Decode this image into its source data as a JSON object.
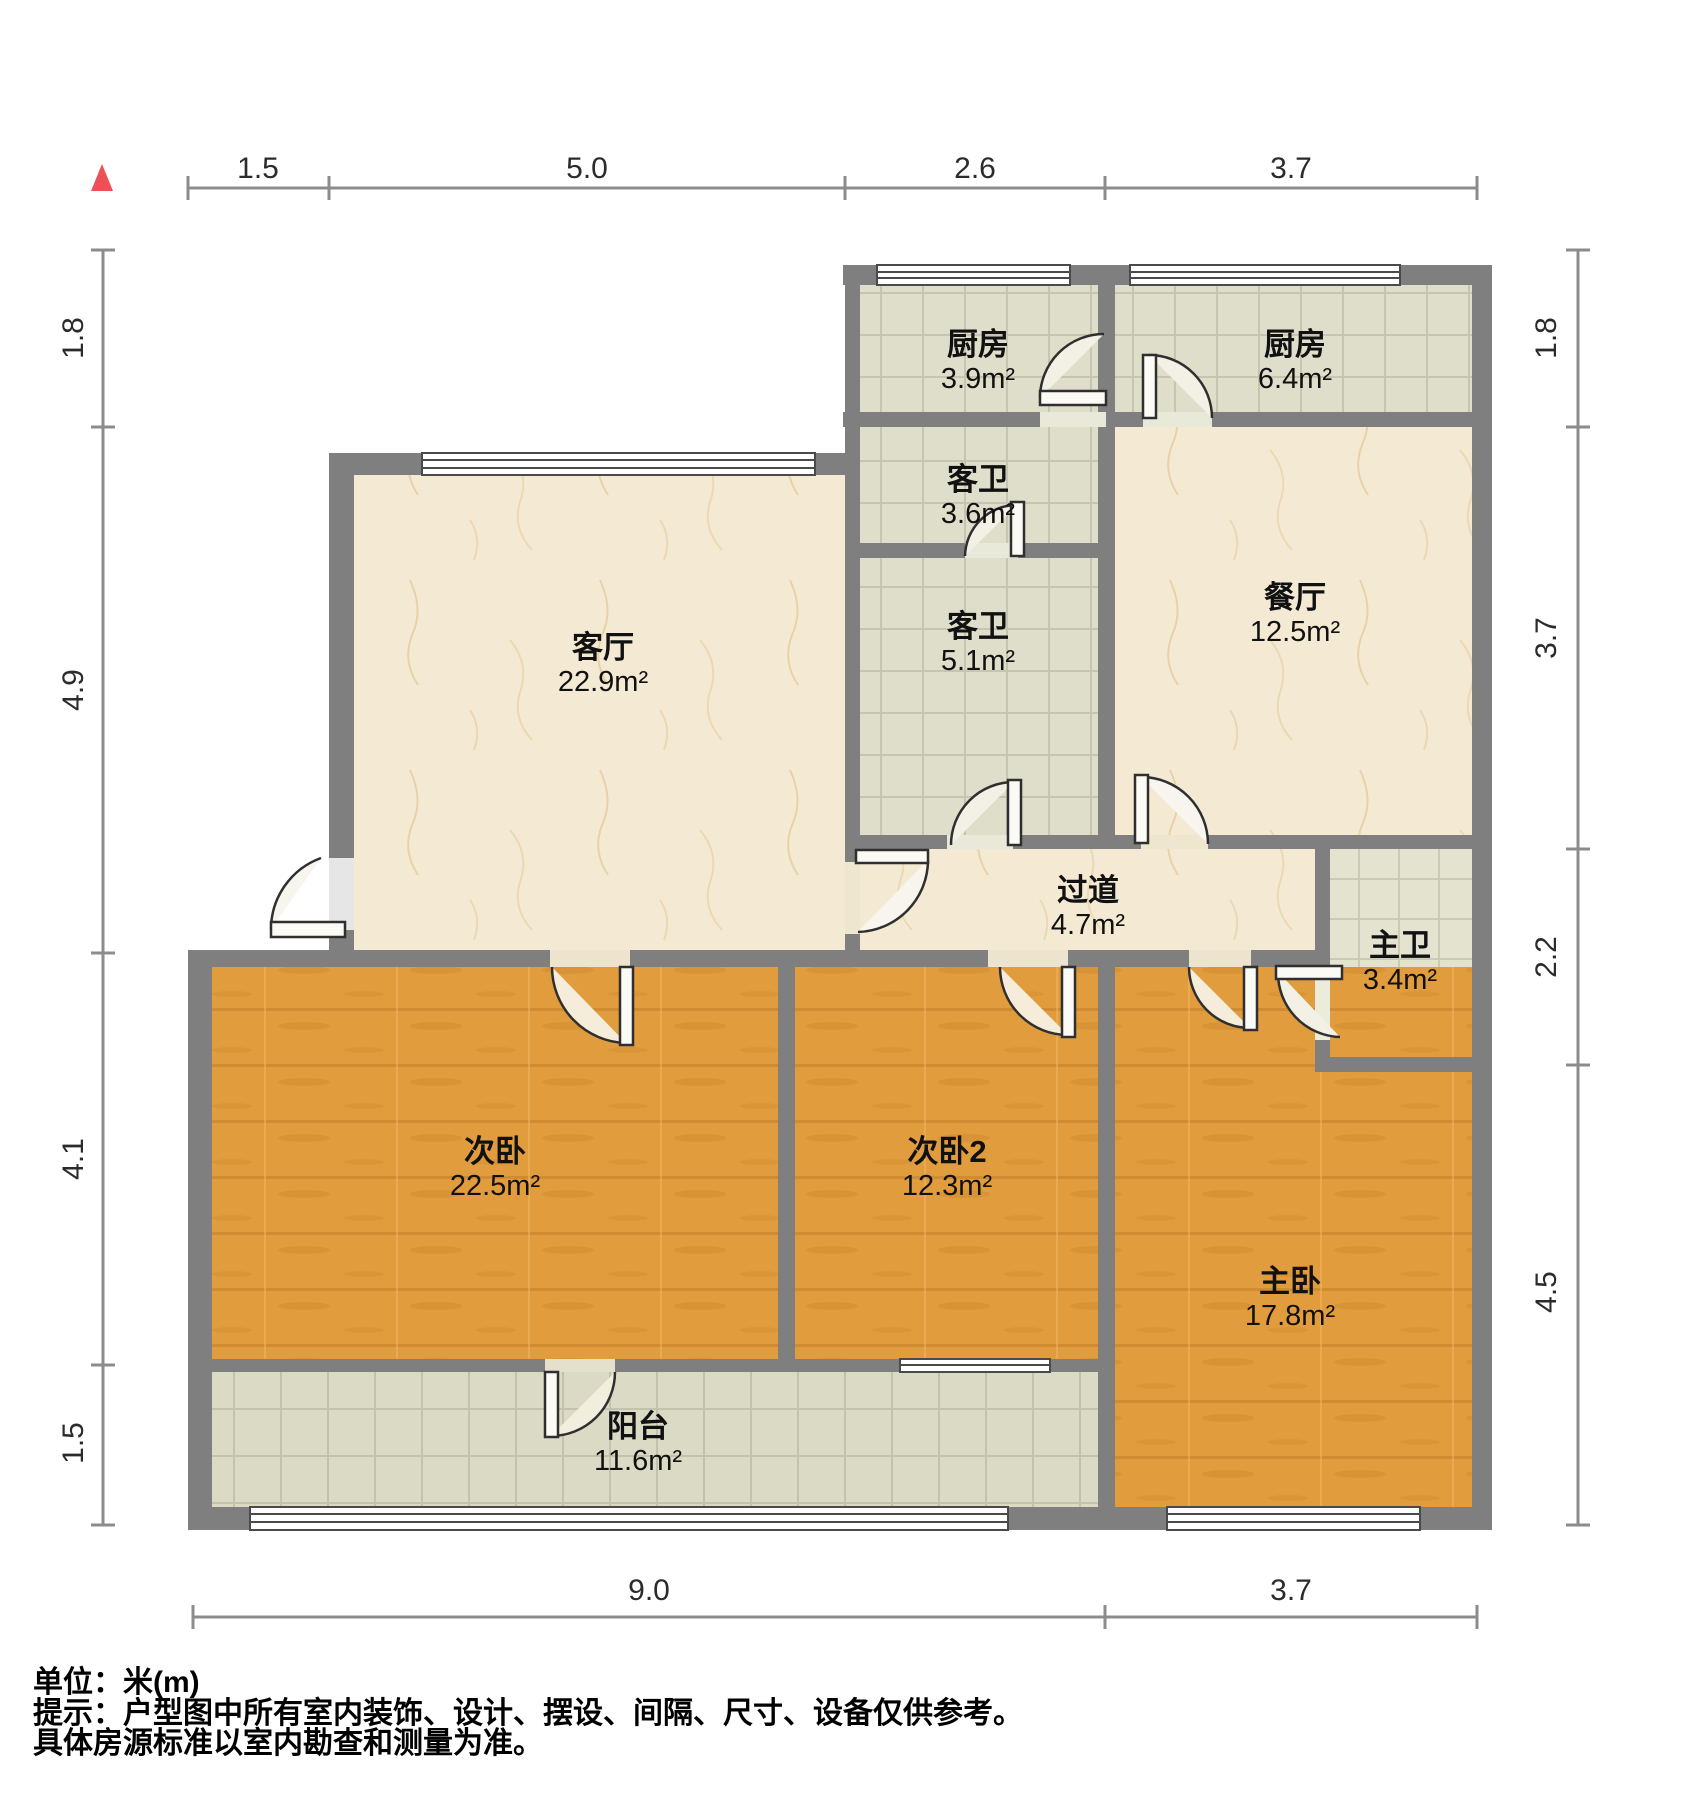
{
  "title": "户型图",
  "north_indicator": "north-arrow",
  "colors": {
    "wall": "#7f7f7f",
    "north_arrow_red": "#ee5055",
    "marble_floor": "#f4ead4",
    "tile_floor": "#dedeca",
    "balcony_tile_floor": "#dbdbc5",
    "master_bath_tile": "#e3e3d0",
    "wood_floor": "#e19c3e",
    "dim_line": "#8c8c8c",
    "dim_text": "#2b2b2b"
  },
  "rooms": [
    {
      "name": "厨房",
      "area": "3.9m²"
    },
    {
      "name": "厨房",
      "area": "6.4m²"
    },
    {
      "name": "客卫",
      "area": "3.6m²"
    },
    {
      "name": "客卫",
      "area": "5.1m²"
    },
    {
      "name": "餐厅",
      "area": "12.5m²"
    },
    {
      "name": "客厅",
      "area": "22.9m²"
    },
    {
      "name": "过道",
      "area": "4.7m²"
    },
    {
      "name": "主卫",
      "area": "3.4m²"
    },
    {
      "name": "次卧",
      "area": "22.5m²"
    },
    {
      "name": "次卧2",
      "area": "12.3m²"
    },
    {
      "name": "主卧",
      "area": "17.8m²"
    },
    {
      "name": "阳台",
      "area": "11.6m²"
    }
  ],
  "dimensions": {
    "top": [
      "1.5",
      "5.0",
      "2.6",
      "3.7"
    ],
    "left": [
      "1.8",
      "4.9",
      "4.1",
      "1.5"
    ],
    "right": [
      "1.8",
      "3.7",
      "2.2",
      "4.5"
    ],
    "bottom": [
      "9.0",
      "3.7"
    ]
  },
  "footer": {
    "unit_line": "单位：米(m)",
    "hint_line1": "提示：户型图中所有室内装饰、设计、摆设、间隔、尺寸、设备仅供参考。",
    "hint_line2": "具体房源标准以室内勘查和测量为准。"
  }
}
